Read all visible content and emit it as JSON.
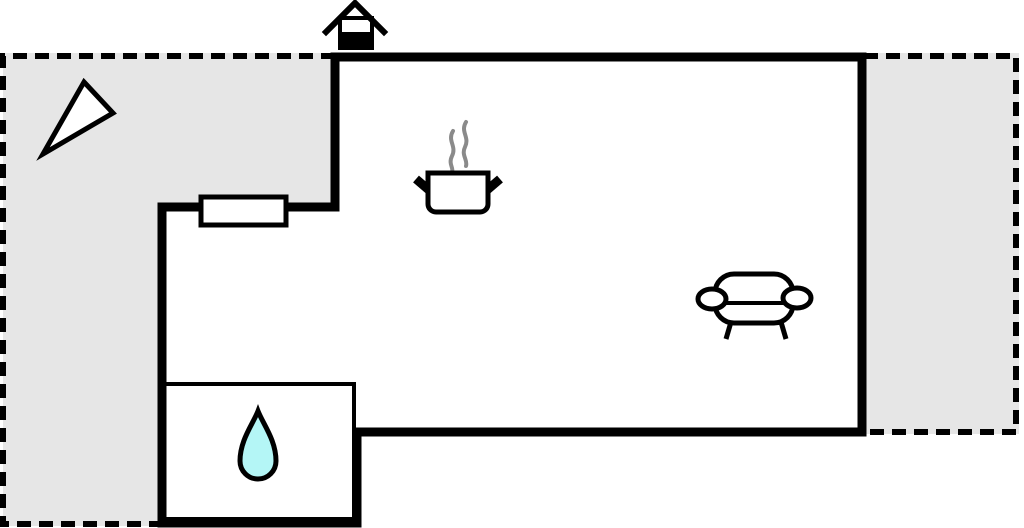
{
  "colors": {
    "background": "#ffffff",
    "room_fill": "#ffffff",
    "wall": "#000000",
    "terrace_fill": "#e6e6e6",
    "dashed_border": "#000000",
    "icon_outline": "#000000",
    "icon_fill": "#ffffff",
    "chimney_solid": "#000000",
    "steam": "#8a8a8a",
    "water_drop_fill": "#b4f6f6"
  },
  "areas": [
    {
      "name": "terrace-left"
    },
    {
      "name": "terrace-right"
    },
    {
      "name": "main-room"
    },
    {
      "name": "annex-room"
    },
    {
      "name": "bathroom"
    }
  ],
  "icons": [
    {
      "name": "chimney-icon"
    },
    {
      "name": "north-arrow-icon"
    },
    {
      "name": "cooking-pot-icon"
    },
    {
      "name": "steam-icon"
    },
    {
      "name": "sofa-icon"
    },
    {
      "name": "water-drop-icon"
    },
    {
      "name": "window-icon"
    }
  ]
}
